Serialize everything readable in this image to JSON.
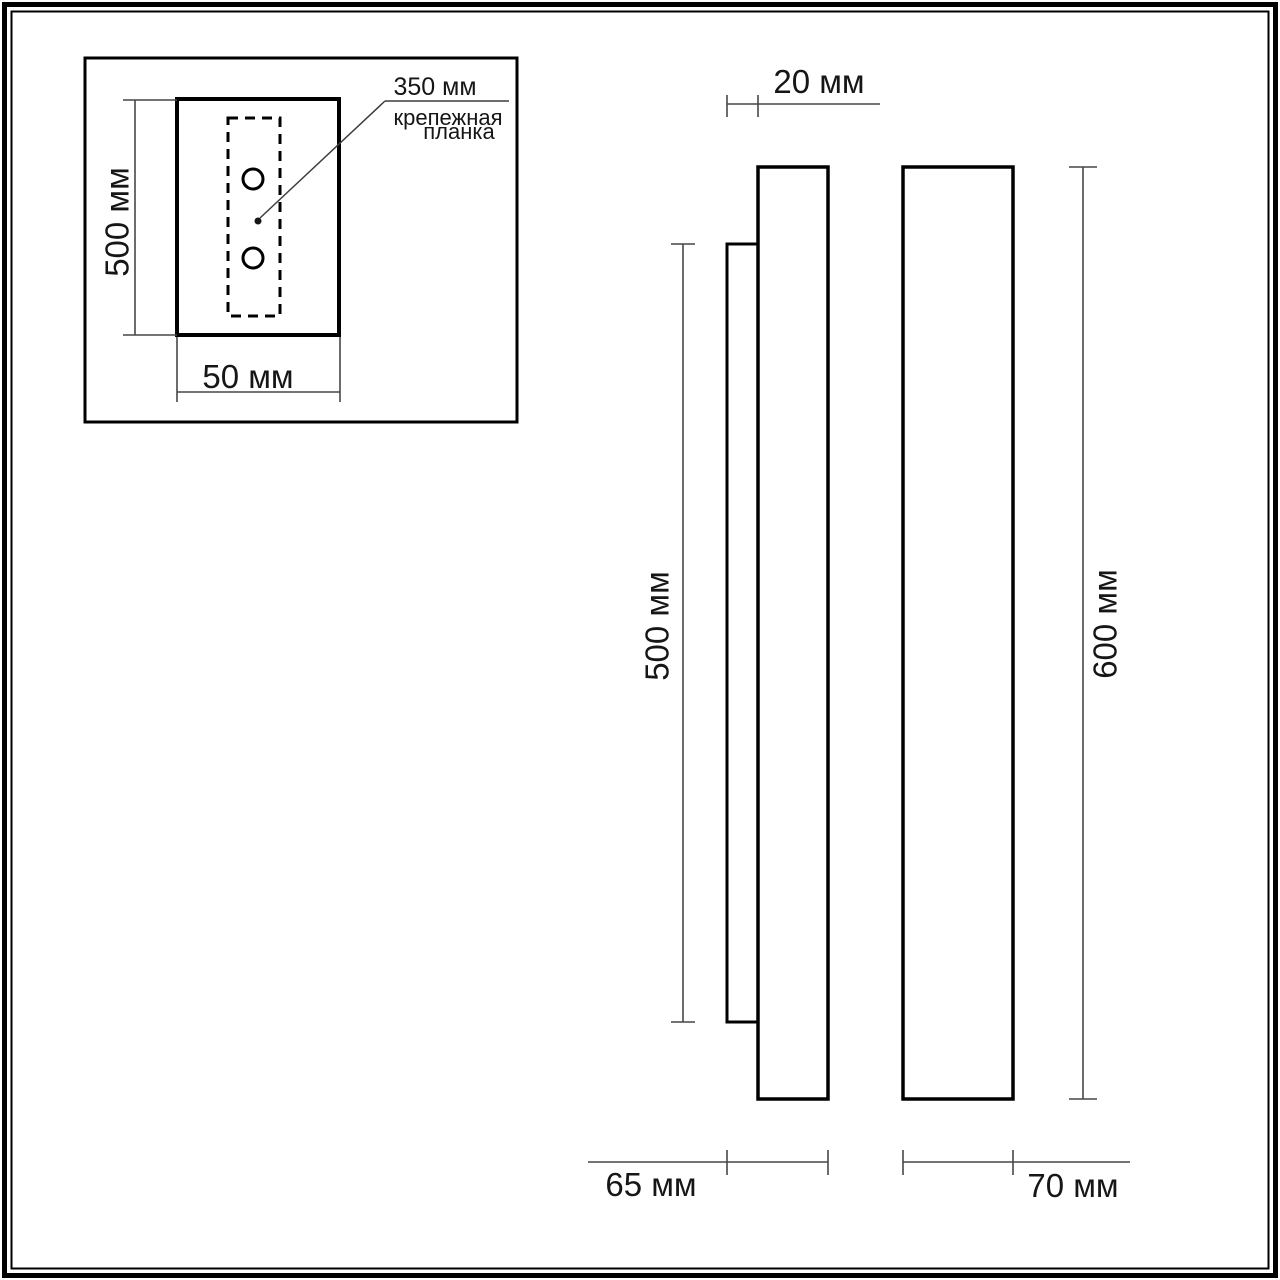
{
  "drawing": {
    "inset": {
      "height_label": "500 мм",
      "width_label": "50 мм",
      "bracket_length_label": "350 мм",
      "bracket_caption_line1": "крепежная",
      "bracket_caption_line2": "планка"
    },
    "side_view": {
      "plate_depth_label": "20 мм",
      "plate_height_label": "500 мм",
      "total_depth_label": "65 мм"
    },
    "front_view": {
      "height_label": "600 мм",
      "width_label": "70 мм"
    }
  }
}
